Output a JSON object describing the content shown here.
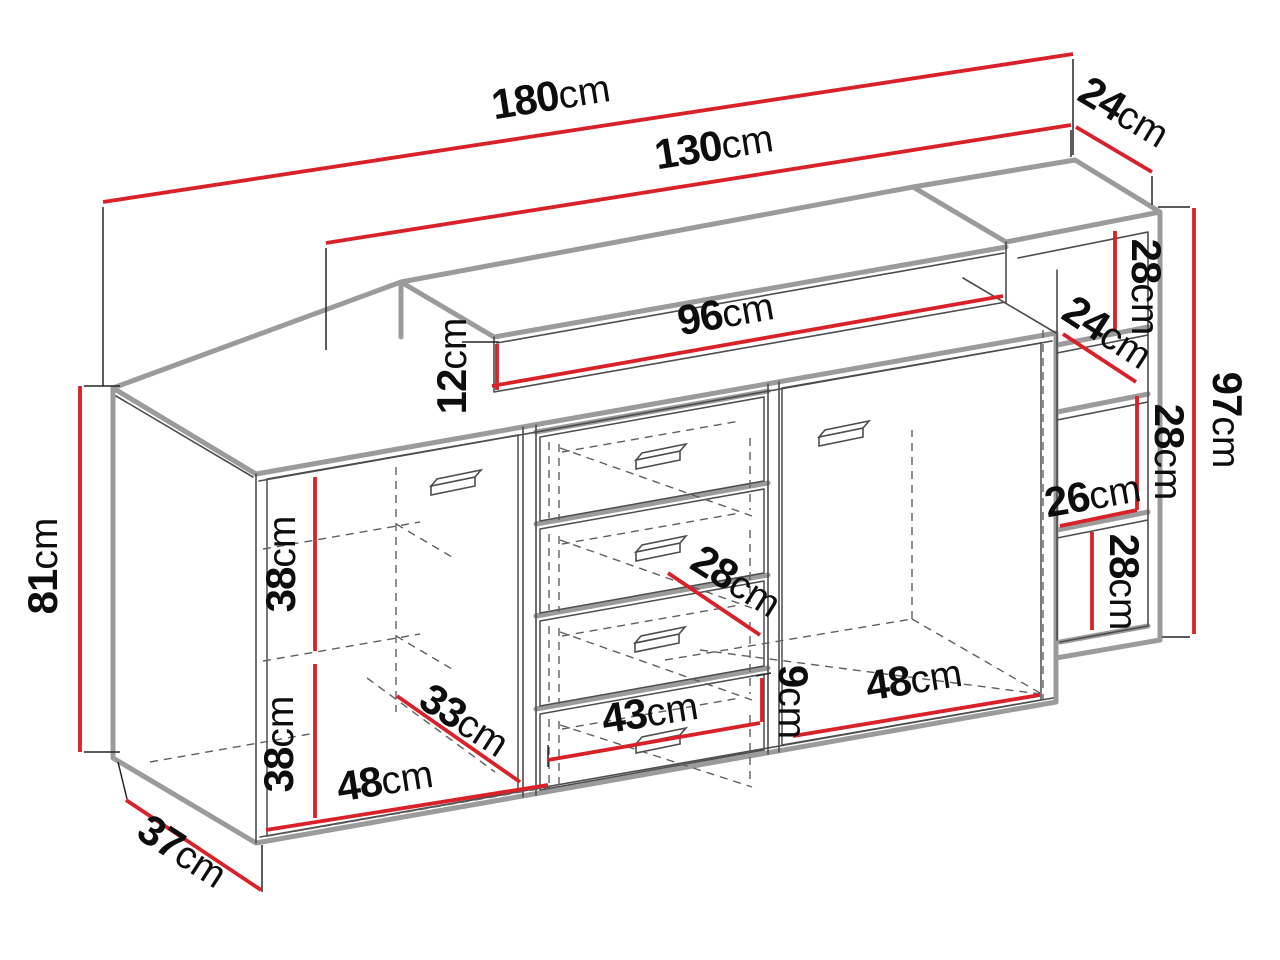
{
  "diagram": {
    "type": "furniture-dimension-drawing",
    "subject": "sideboard with doors, drawers, top shelf and open side shelving",
    "background_color": "#ffffff",
    "dimension_line_color": "#d92129",
    "edge_shadow_color": "#9b9b9b",
    "outline_color": "#4d4d4d",
    "label_color": "#0d0d0d"
  },
  "dimensions": {
    "total_width": {
      "value": "180",
      "unit": "cm"
    },
    "upper_section_width": {
      "value": "130",
      "unit": "cm"
    },
    "top_depth": {
      "value": "24",
      "unit": "cm"
    },
    "right_top_compartment_height": {
      "value": "28",
      "unit": "cm"
    },
    "right_shelf_depth": {
      "value": "24",
      "unit": "cm"
    },
    "right_total_height": {
      "value": "97",
      "unit": "cm"
    },
    "right_middle_compartment_height": {
      "value": "28",
      "unit": "cm"
    },
    "right_compartment_width": {
      "value": "26",
      "unit": "cm"
    },
    "right_lower_compartment_height": {
      "value": "28",
      "unit": "cm"
    },
    "top_shelf_width": {
      "value": "96",
      "unit": "cm"
    },
    "top_shelf_height": {
      "value": "12",
      "unit": "cm"
    },
    "left_height": {
      "value": "81",
      "unit": "cm"
    },
    "left_upper_compartment_height": {
      "value": "38",
      "unit": "cm"
    },
    "left_lower_compartment_height": {
      "value": "38",
      "unit": "cm"
    },
    "drawer_inner_depth": {
      "value": "28",
      "unit": "cm"
    },
    "interior_depth": {
      "value": "33",
      "unit": "cm"
    },
    "drawer_width": {
      "value": "43",
      "unit": "cm"
    },
    "drawer_bottom_height": {
      "value": "9",
      "unit": "cm"
    },
    "right_door_width": {
      "value": "48",
      "unit": "cm"
    },
    "left_door_width": {
      "value": "48",
      "unit": "cm"
    },
    "bottom_depth": {
      "value": "37",
      "unit": "cm"
    }
  }
}
